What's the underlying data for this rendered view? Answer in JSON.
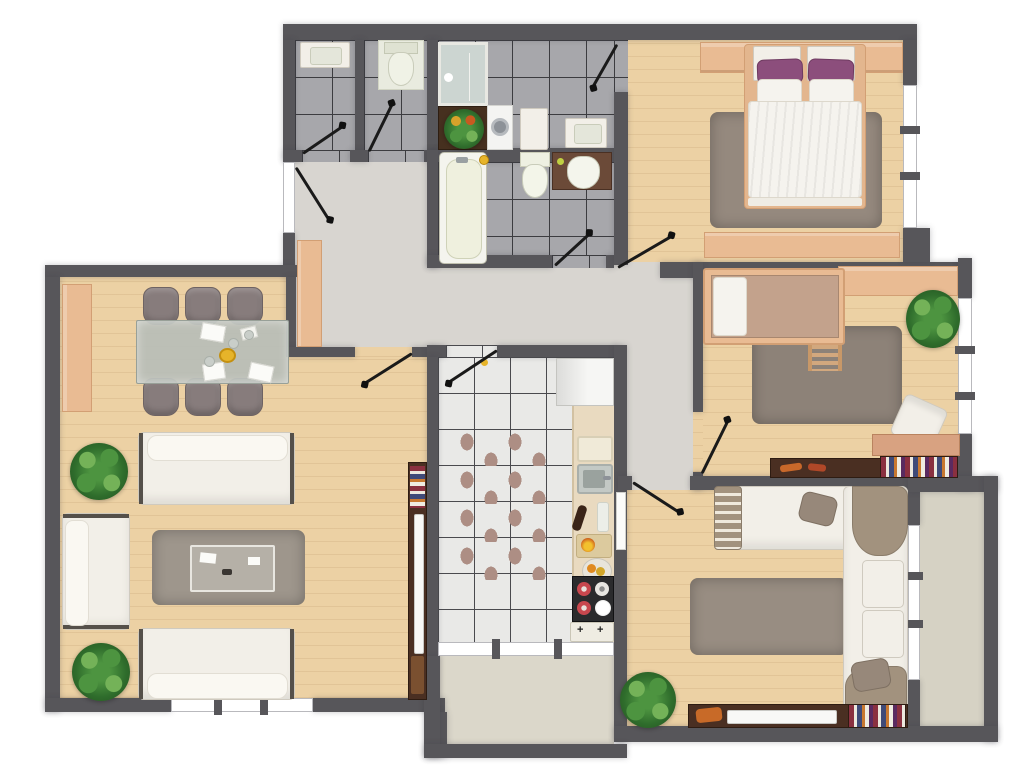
{
  "app": {
    "name": "Apartment 3D Floor Plan",
    "view": "top-down-render"
  },
  "palette": {
    "wall": "#57565a",
    "wood": "#ecd1a4",
    "woodline": "rgba(160,120,70,0.14)",
    "hall": "#d8d5d0",
    "tileg": "#a7a7ab",
    "tilew": "#e9e9e7",
    "grout": "#3c3c40",
    "groutw": "#4a4a4e",
    "balc1": "#dbd7ca",
    "balc2": "#d6d2c4",
    "peach": "#e9bb93",
    "peachd": "#d29f74",
    "rug": "#95897e",
    "petal": "#ad8e84",
    "white": "#f2efe8",
    "whiteb": "#cfcabf",
    "taupe": "#a2927e",
    "chair": "#877c7c",
    "chairb": "#6e6363",
    "glass": "#b7bdb7",
    "purple": "#8c4e7c",
    "duvet": "#f5f3ee",
    "dwood": "#4a2f22",
    "p1": "#2f6d2c",
    "p2": "#4d9440",
    "p3": "#74b258",
    "steel": "#c3c9c5",
    "stove": "#2b2b2d",
    "red": "#c8474e",
    "cream": "#eff0de",
    "counter": "#e9dac0",
    "bcount": "#6b4a38",
    "gold": "#e6b42a",
    "dline": "#1a1a1a"
  },
  "rooms": [
    {
      "id": "living-dining-room",
      "label": "Living / Dining Room",
      "furniture": [
        "sideboard",
        "dining-table",
        "dining-chairs-x6",
        "fruit-bowl",
        "sofa",
        "sofa",
        "armchair",
        "coffee-table",
        "rug",
        "plant",
        "plant",
        "tv-bookcase"
      ]
    },
    {
      "id": "kitchen",
      "label": "Kitchen",
      "furniture": [
        "fridge",
        "counter",
        "cutting-board",
        "sink",
        "wine-bottle",
        "fruit-bowl",
        "stove",
        "gas-hob",
        "rug"
      ]
    },
    {
      "id": "hallway",
      "label": "Hallway",
      "furniture": [
        "cabinet"
      ]
    },
    {
      "id": "wc-washbasin",
      "label": "WC",
      "furniture": [
        "washbasin"
      ]
    },
    {
      "id": "wc-toilet",
      "label": "WC",
      "furniture": [
        "toilet"
      ]
    },
    {
      "id": "bathroom-laundry",
      "label": "Bathroom / Laundry",
      "furniture": [
        "shower",
        "plant-box",
        "washing-machine",
        "cabinet",
        "washbasin"
      ]
    },
    {
      "id": "bathroom-main",
      "label": "Bathroom",
      "furniture": [
        "bathtub",
        "toilet",
        "vanity-basin"
      ]
    },
    {
      "id": "master-bedroom",
      "label": "Master Bedroom",
      "furniture": [
        "wardrobe",
        "double-bed",
        "pillows-purple",
        "rug",
        "dresser"
      ]
    },
    {
      "id": "kids-bedroom",
      "label": "Kids Bedroom",
      "furniture": [
        "wardrobe",
        "single-bed",
        "ladder",
        "rug",
        "plant",
        "desk",
        "desk-chair",
        "bookshelf"
      ]
    },
    {
      "id": "family-room",
      "label": "Family Room",
      "furniture": [
        "corner-sofa",
        "cushions",
        "rug",
        "plant",
        "tv-stand",
        "books"
      ]
    },
    {
      "id": "balcony-south",
      "label": "Balcony",
      "furniture": []
    },
    {
      "id": "balcony-east",
      "label": "Balcony",
      "furniture": []
    }
  ]
}
